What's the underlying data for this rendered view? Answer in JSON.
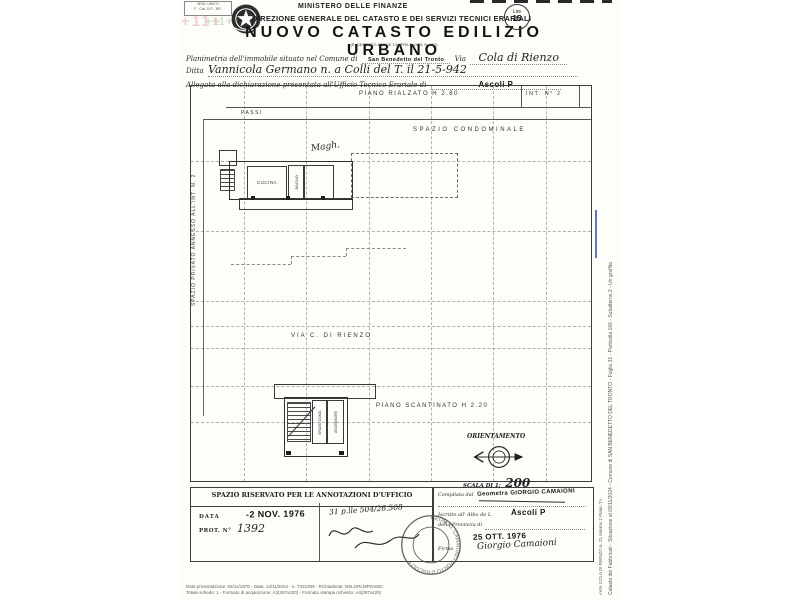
{
  "document": {
    "corner_box": {
      "line1": "MOD. UNICO",
      "line2": "F - Cat. S.P. - BR."
    },
    "watermark": "+11+",
    "header": {
      "ministry": "MINISTERO DELLE FINANZE",
      "directorate": "DIREZIONE GENERALE DEL CATASTO E DEI SERVIZI TECNICI ERARIALI",
      "title": "NUOVO CATASTO EDILIZIO URBANO",
      "decree": "(R. DECRETO-LEGGE 13 APRILE 1939, N. 652)"
    },
    "revenue_stamp": {
      "line1": "Lire",
      "line2": "15"
    },
    "form": {
      "comune_label": "Planimetria dell'immobile situato nel Comune di",
      "comune_value": "San Benedetto del Tronto",
      "via_label": "Via",
      "via_value": "Cola di Rienzo",
      "ditta_label": "Ditta",
      "ditta_value": "Vannicola Germano n. a Colli del T. il 21-5-942",
      "ufficio_label": "Allegata alla dichiarazione presentata all'Ufficio Tecnico Erariale di",
      "ufficio_value": "Ascoli P"
    },
    "plan": {
      "floor_title": "PIANO RIALZATO H 2.80",
      "unit_label": "INT. N° 2",
      "passi": "PASSI",
      "condo": "SPAZIO CONDOMINALE",
      "left_label": "SPAZIO PRIVATO ANNESSO ALL'INT. N. 2",
      "kitchen": "CUCINA",
      "bath": "BAGNO",
      "note": "Magh.",
      "street": "VIA C. DI RIENZO",
      "basement_title": "PIANO SCANTINATO H 2.20",
      "basement_room1": "SPAZIO COND.",
      "basement_room2": "ASCENSORE",
      "orientation": "ORIENTAMENTO",
      "scale_label": "SCALA DI 1:",
      "scale_value": "200"
    },
    "office_box": {
      "title": "SPAZIO RISERVATO PER LE ANNOTAZIONI D'UFFICIO",
      "data_label": "DATA",
      "data_stamp": "-2 NOV. 1976",
      "prot_label": "PROT. N°",
      "prot_value": "1392",
      "note": "31 p.lle 504/26.508"
    },
    "surveyor_box": {
      "compiled_label": "Compilata dal",
      "compiled_stamp": "Geometra GIORGIO CAMAIONI",
      "albo_label": "Iscritto all' Albo de L.",
      "albo_value": "Ascoli P",
      "provincia_label": "della Provincia di",
      "date_stamp": "25 OTT. 1976",
      "firma_label": "Firma",
      "signature": "Giorgio Camaioni",
      "round_stamp": "GEOM. G. CAMAIONI • PORTO D'ASCOLI •"
    },
    "margin": {
      "archive_line": "Catasto dei Fabbricati - Situazione al 03/11/2024 - Comune di SAN BENEDETTO DEL TRONTO - Foglio 31 - Particella 166 - Subalterno 2 - Un graffito",
      "address_line": "«VIA COLA DI RIENZO n. 21 Interno 2 Piano T»",
      "print_line1": "Data presentazione: 02/11/1976 - Data: 13/11/2024 - n. T321309 - Richiedente: NSLGRLMP0A60C",
      "print_line2": "Totale schede: 1 - Formato di acquisizione: A3(297x420) - Formato stampa richiesto: A4(297x420)"
    },
    "colors": {
      "ink": "#2b2b2b",
      "blue_mark": "#4a5fb0"
    }
  }
}
